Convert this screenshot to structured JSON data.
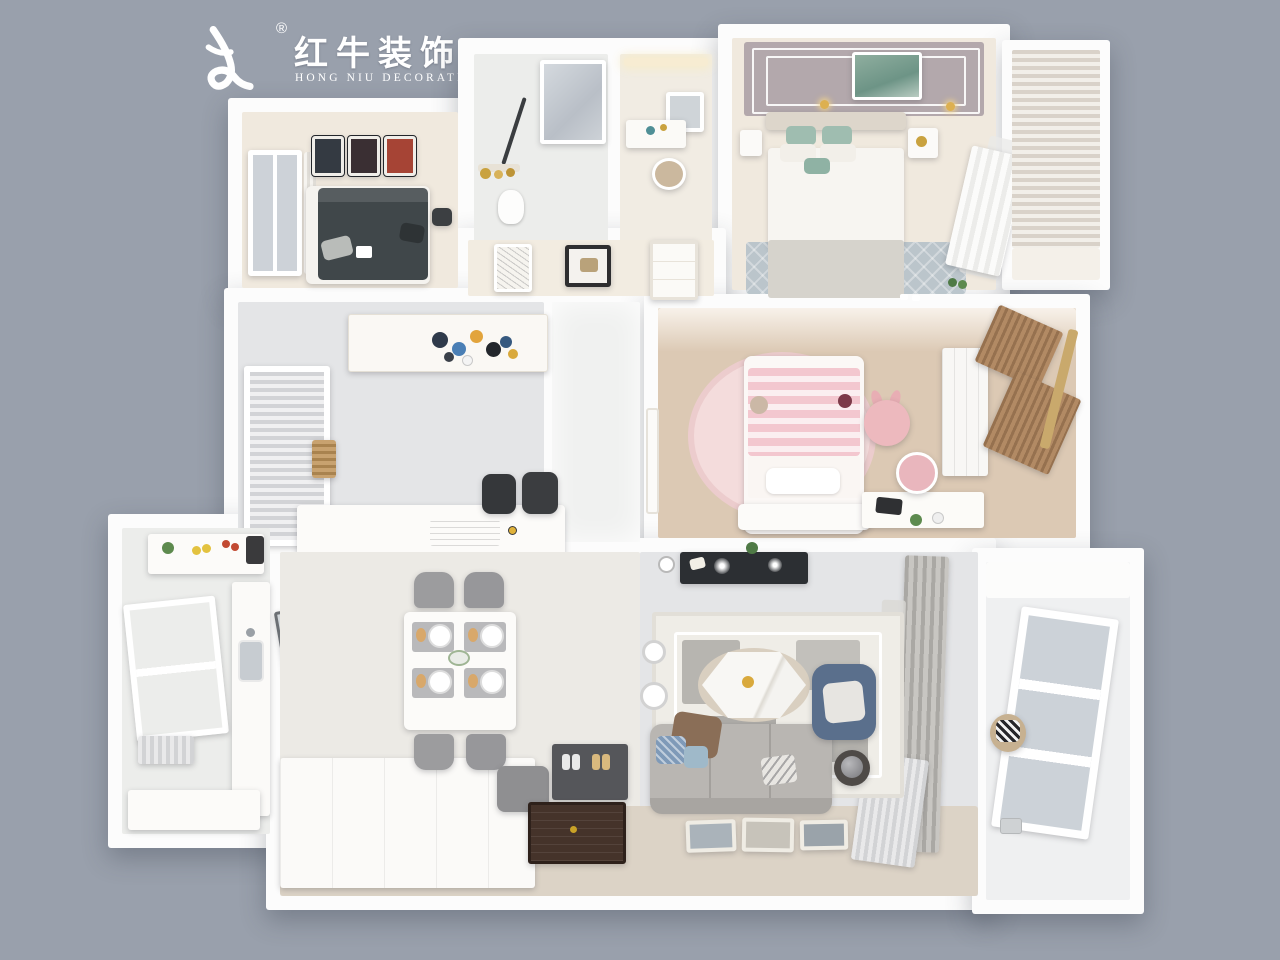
{
  "brand": {
    "logo_mark": "bull-swoosh-icon",
    "registered": "®",
    "name_zh": "红牛装饰",
    "name_en": "HONG NIU DECORATION"
  },
  "render": {
    "type": "3d-floorplan-top-down-render",
    "rooms": [
      {
        "name": "guest-bedroom",
        "position": "top-left",
        "items": [
          "dark-daybed",
          "three-wall-art-frames",
          "curtained-window",
          "black-stool"
        ]
      },
      {
        "name": "bathroom",
        "position": "top-center",
        "items": [
          "glass-shower",
          "toilet",
          "gold-vases-shelf",
          "tiled-floor"
        ]
      },
      {
        "name": "vanity-room",
        "position": "top-center-right",
        "items": [
          "lighted-mirror",
          "makeup-desk",
          "rattan-chair",
          "cove-light"
        ]
      },
      {
        "name": "master-bedroom",
        "position": "top-right",
        "items": [
          "panel-ceiling",
          "green-wall-art",
          "wall-sconces",
          "double-bed-green-pillows",
          "nightstands",
          "blue-gray-rug",
          "sheer-curtain-window",
          "shutter-balcony"
        ]
      },
      {
        "name": "hallway",
        "position": "center",
        "items": [
          "framed-art",
          "white-panel-door",
          "bright-tile-walkway"
        ]
      },
      {
        "name": "tea-room",
        "position": "middle-left",
        "items": [
          "colorful-pendant-cluster",
          "blinds-window",
          "wood-slat-stack",
          "white-island-counter",
          "two-black-chairs",
          "tiled-floor"
        ]
      },
      {
        "name": "kids-bedroom",
        "position": "middle-right",
        "items": [
          "round-pink-rug",
          "pink-striped-bed",
          "teddy-bear",
          "rabbit-plush-chair",
          "white-desk-with-laptop",
          "pink-desk-chair",
          "wardrobe",
          "brown-curtains",
          "wood-floor"
        ]
      },
      {
        "name": "kitchen",
        "position": "bottom-left",
        "items": [
          "white-counters",
          "sink",
          "window",
          "groceries",
          "glass-door",
          "radiator"
        ]
      },
      {
        "name": "dining-room",
        "position": "bottom-center-left",
        "items": [
          "white-dining-table",
          "four-gray-chairs",
          "plates-and-placemats",
          "flower-centerpiece",
          "white-sideboard",
          "gray-bench",
          "shoe-cabinet-with-slippers",
          "dark-entry-mat"
        ]
      },
      {
        "name": "living-room",
        "position": "bottom-center-right",
        "items": [
          "dark-tv-console",
          "wall-clock",
          "geometric-rug",
          "hexagon-marble-coffee-table",
          "floor-lamps",
          "gray-sofa-with-pillows",
          "blue-armchair",
          "round-side-table",
          "gray-curtains",
          "leaning-picture-frames",
          "plant"
        ]
      },
      {
        "name": "laundry-balcony",
        "position": "bottom-right",
        "items": [
          "white-tile-walls",
          "paned-window",
          "laundry-basket-zebra-towel",
          "floor-drain"
        ]
      }
    ]
  },
  "palette": {
    "bg": "#99A0AC",
    "wall": "#FCFCFC",
    "floor-warm": "#F0E9DE",
    "floor-tile": "#ECEDEB",
    "floor-cool": "#E4E5E7",
    "floor-wood": "#DCC9B4",
    "pink": "#F2C7CE",
    "blue": "#5A6F8C",
    "green": "#9FBDB0",
    "dark": "#2F3236",
    "gold": "#C9A23F",
    "sofa-gray": "#B9B6B2",
    "curtain-brown": "#A07E5C",
    "ceiling-mauve": "#B3A8AC"
  }
}
